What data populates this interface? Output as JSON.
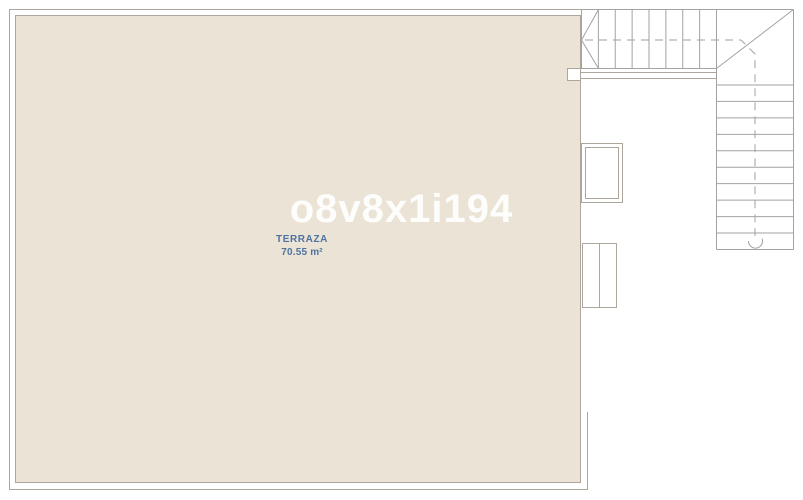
{
  "watermark": {
    "text": "o8v8x1i194"
  },
  "terrace": {
    "name": "TERRAZA",
    "area": "70.55 m²"
  },
  "stair": {
    "shape": "L",
    "top_run_treads": 8,
    "right_run_treads": 11,
    "walk_line_style": "dashed",
    "start_marker": "arc"
  },
  "colors": {
    "background": "#FFFFFF",
    "terrace_fill": "#EAE3D6",
    "wall_line": "#ACA69D",
    "stair_line": "#A2A2A2",
    "label": "#4E73A0",
    "watermark": "#FFFFFF"
  }
}
